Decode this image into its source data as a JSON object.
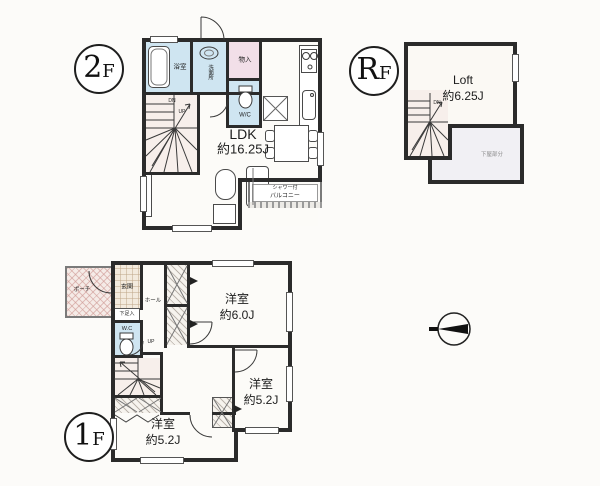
{
  "floors": {
    "second": {
      "badge": {
        "big": "2",
        "small": "F"
      },
      "rooms": {
        "ldk": {
          "name": "LDK",
          "size": "約16.25J"
        },
        "bath": "浴室",
        "washroom": "洗面所",
        "storage": "物入",
        "toilet": "W/C",
        "balcony": {
          "line1": "シャワー付",
          "line2": "バルコニー"
        }
      },
      "stairs": {
        "down": "DN",
        "up": "UP"
      }
    },
    "roof": {
      "badge": {
        "big": "R",
        "small": "F"
      },
      "rooms": {
        "loft": {
          "name": "Loft",
          "size": "約6.25J"
        },
        "lower_roof": "下屋部分"
      },
      "stairs": {
        "down": "DN"
      }
    },
    "first": {
      "badge": {
        "big": "1",
        "small": "F"
      },
      "rooms": {
        "porch": "ポーチ",
        "entrance": "玄関",
        "hall": "ホール",
        "shoe_storage": "下足入",
        "toilet": "W.C",
        "bedroom1": {
          "name": "洋室",
          "size": "約6.0J"
        },
        "bedroom2": {
          "name": "洋室",
          "size": "約5.2J"
        },
        "bedroom3": {
          "name": "洋室",
          "size": "約5.2J"
        }
      },
      "stairs": {
        "up": "UP"
      }
    }
  },
  "colors": {
    "wall": "#2b2b2b",
    "water_room": "#cfe5f1",
    "storage_pink": "#f2dfe8",
    "stair_tint": "#f7efeb",
    "paper": "#fcfbf9"
  }
}
